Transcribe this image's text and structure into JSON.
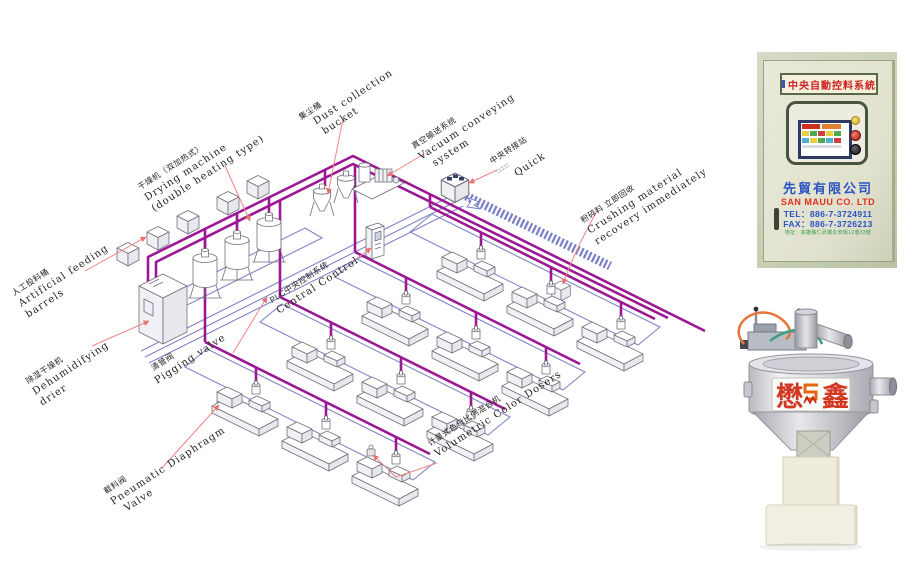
{
  "diagram": {
    "labels": {
      "artificial_feeding": {
        "zh": "人工投料桶",
        "en1": "Artificial feeding",
        "en2": "barrels"
      },
      "drying_machine": {
        "zh": "干燥机（双加热式）",
        "en1": "Drying machine",
        "en2": "(double heating type)"
      },
      "dust_collection": {
        "zh": "集尘桶",
        "en1": "Dust collection",
        "en2": "bucket"
      },
      "vacuum_conveying": {
        "zh": "真空输送系统",
        "en1": "Vacuum conveying",
        "en2": "system"
      },
      "central_transfer": {
        "zh": "中央转接站",
        "en1": "□□□□",
        "en2": "Quick"
      },
      "crushing": {
        "zh": "粉碎料 立即回收",
        "en1": "Crushing material",
        "en2": "recovery immediately"
      },
      "plc": {
        "zh": "PLC中央控制系统",
        "en1": "Central Control"
      },
      "dehumidifying": {
        "zh": "除湿干燥机",
        "en1": "Dehumidifying",
        "en2": "drier"
      },
      "pigging": {
        "zh": "清管阀",
        "en1": "Pigging valve"
      },
      "pneumatic_valve": {
        "zh": "截料阀",
        "en1": "Pneumatic Diaphragm",
        "en2": "Valve"
      },
      "volumetric": {
        "zh": "计量式色母比例混合机",
        "en1": "Volumetric Color Dosers"
      }
    },
    "colors": {
      "pipe": "#9c1793",
      "return_line": "#8086c6",
      "leader": "#ef8585",
      "outline": "#70707a"
    }
  },
  "cabinet": {
    "plaque": "中央自動控料系統",
    "company_zh": "先貿有限公司",
    "company_en": "SAN MAUU CO. LTD",
    "tel": "TEL：886-7-3724911",
    "fax": "FAX：886-7-3726213",
    "address": "地址：高雄縣仁武鄉永安街12巷33號"
  },
  "hopper": {
    "brand_left": "懋",
    "brand_right": "鑫"
  }
}
